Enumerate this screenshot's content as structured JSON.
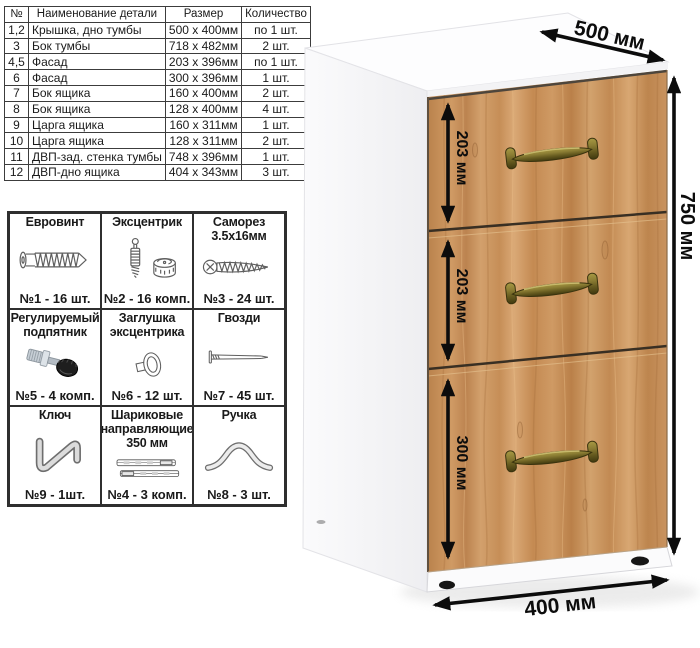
{
  "parts_table": {
    "headers": [
      "№",
      "Наименование детали",
      "Размер",
      "Количество"
    ],
    "rows": [
      [
        "1,2",
        "Крышка, дно тумбы",
        "500 x 400мм",
        "по 1 шт."
      ],
      [
        "3",
        "Бок тумбы",
        "718 x 482мм",
        "2 шт."
      ],
      [
        "4,5",
        "Фасад",
        "203 x 396мм",
        "по 1 шт."
      ],
      [
        "6",
        "Фасад",
        "300 x 396мм",
        "1 шт."
      ],
      [
        "7",
        "Бок ящика",
        "160 x 400мм",
        "2 шт."
      ],
      [
        "8",
        "Бок ящика",
        "128 x 400мм",
        "4 шт."
      ],
      [
        "9",
        "Царга ящика",
        "160 x 311мм",
        "1 шт."
      ],
      [
        "10",
        "Царга ящика",
        "128 x 311мм",
        "2 шт."
      ],
      [
        "11",
        "ДВП-зад. стенка тумбы",
        "748 x 396мм",
        "1 шт."
      ],
      [
        "12",
        "ДВП-дно ящика",
        "404 x 343мм",
        "3 шт."
      ]
    ]
  },
  "hardware": {
    "items": [
      {
        "name": "euro-screw",
        "title": "Евровинт",
        "count": "№1 - 16 шт."
      },
      {
        "name": "cam-lock",
        "title": "Эксцентрик",
        "count": "№2 - 16 комп."
      },
      {
        "name": "self-tapping-screw",
        "title": "Саморез 3.5x16мм",
        "count": "№3 - 24 шт."
      },
      {
        "name": "adjustable-foot",
        "title": "Регулируемый подпятник",
        "count": "№5 - 4 комп."
      },
      {
        "name": "cam-cover",
        "title": "Заглушка эксцентрика",
        "count": "№6 - 12 шт."
      },
      {
        "name": "nails",
        "title": "Гвозди",
        "count": "№7 - 45 шт."
      },
      {
        "name": "hex-key",
        "title": "Ключ",
        "count": "№9 - 1шт."
      },
      {
        "name": "ball-slides",
        "title": "Шариковые направляющие 350 мм",
        "count": "№4 - 3 комп."
      },
      {
        "name": "drawer-handle",
        "title": "Ручка",
        "count": "№8 - 3 шт."
      }
    ]
  },
  "cabinet": {
    "depth_label": "500 мм",
    "height_label": "750 мм",
    "width_label": "400 мм",
    "drawer_labels": [
      "203 мм",
      "203 мм",
      "300 мм"
    ],
    "colors": {
      "wood": "#c9935f",
      "handle": "#7d7130",
      "arrow": "#0c0c0c"
    }
  }
}
